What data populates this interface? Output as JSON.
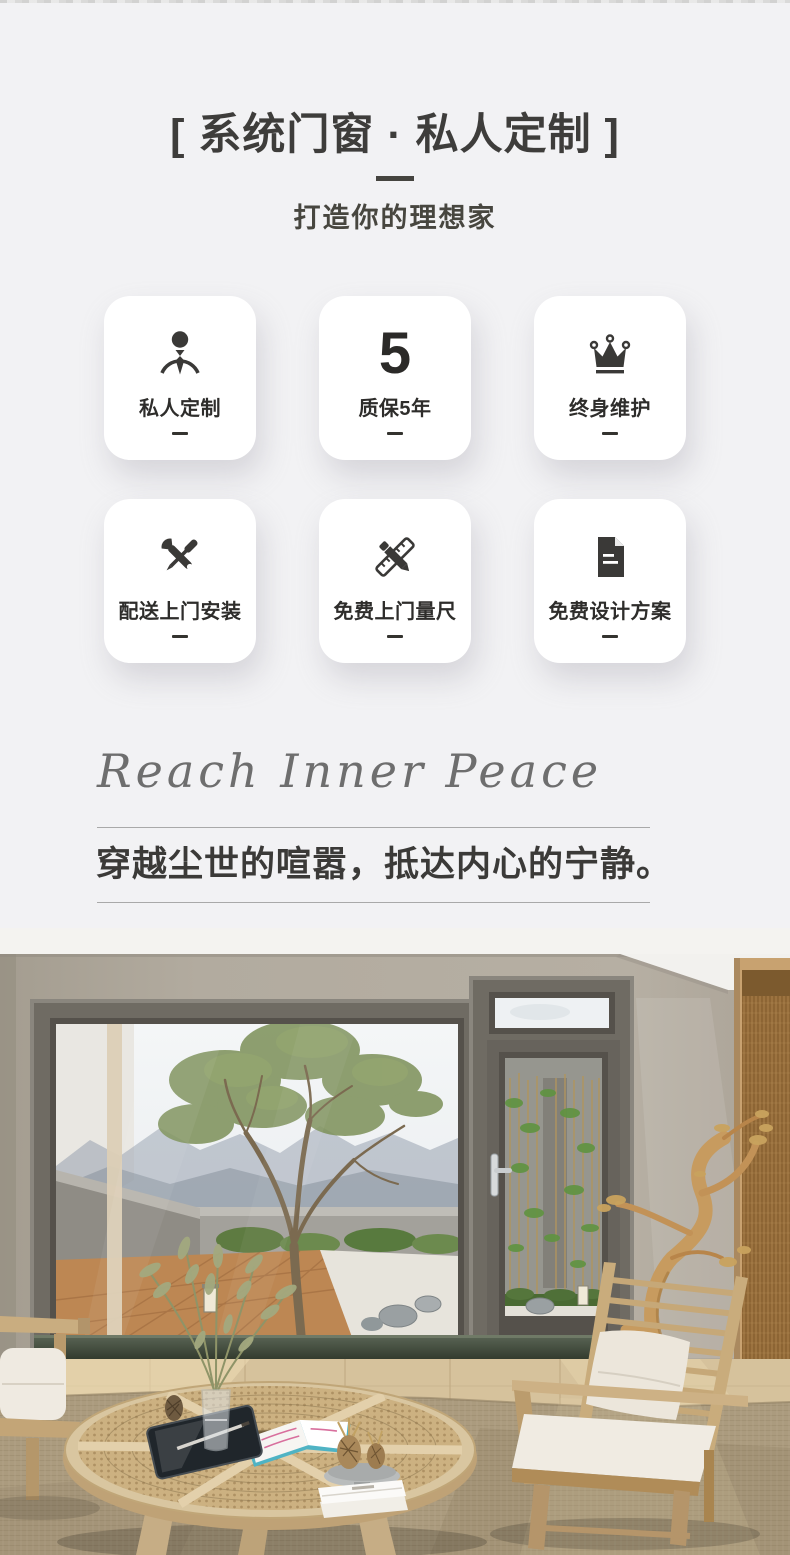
{
  "page": {
    "background": "#f2f2f4"
  },
  "header": {
    "title": "[ 系统门窗 · 私人定制 ]",
    "subtitle": "打造你的理想家"
  },
  "features": {
    "items": [
      {
        "label": "私人定制",
        "icon": "person-tie-icon"
      },
      {
        "label": "质保5年",
        "icon": "number-5",
        "number": "5"
      },
      {
        "label": "终身维护",
        "icon": "crown-icon"
      },
      {
        "label": "配送上门安装",
        "icon": "repair-tools-icon"
      },
      {
        "label": "免费上门量尺",
        "icon": "measuring-tools-icon"
      },
      {
        "label": "免费设计方案",
        "icon": "design-document-icon"
      }
    ]
  },
  "quote": {
    "english": "Reach Inner Peace",
    "chinese": "穿越尘世的喧嚣，抵达内心的宁静。"
  },
  "photo": {
    "alt": "living room with dark-framed panoramic system window and glass door overlooking a zen courtyard with a tree, rattan round table, wooden armchair and woven rug"
  },
  "colors": {
    "ink": "#3a3937",
    "divider": "#a9a9a9",
    "card_bg": "#ffffff",
    "script_gray": "#6e6e6e",
    "wall_greige": "#b0a99d",
    "frame_bronze": "#6f6b63"
  }
}
